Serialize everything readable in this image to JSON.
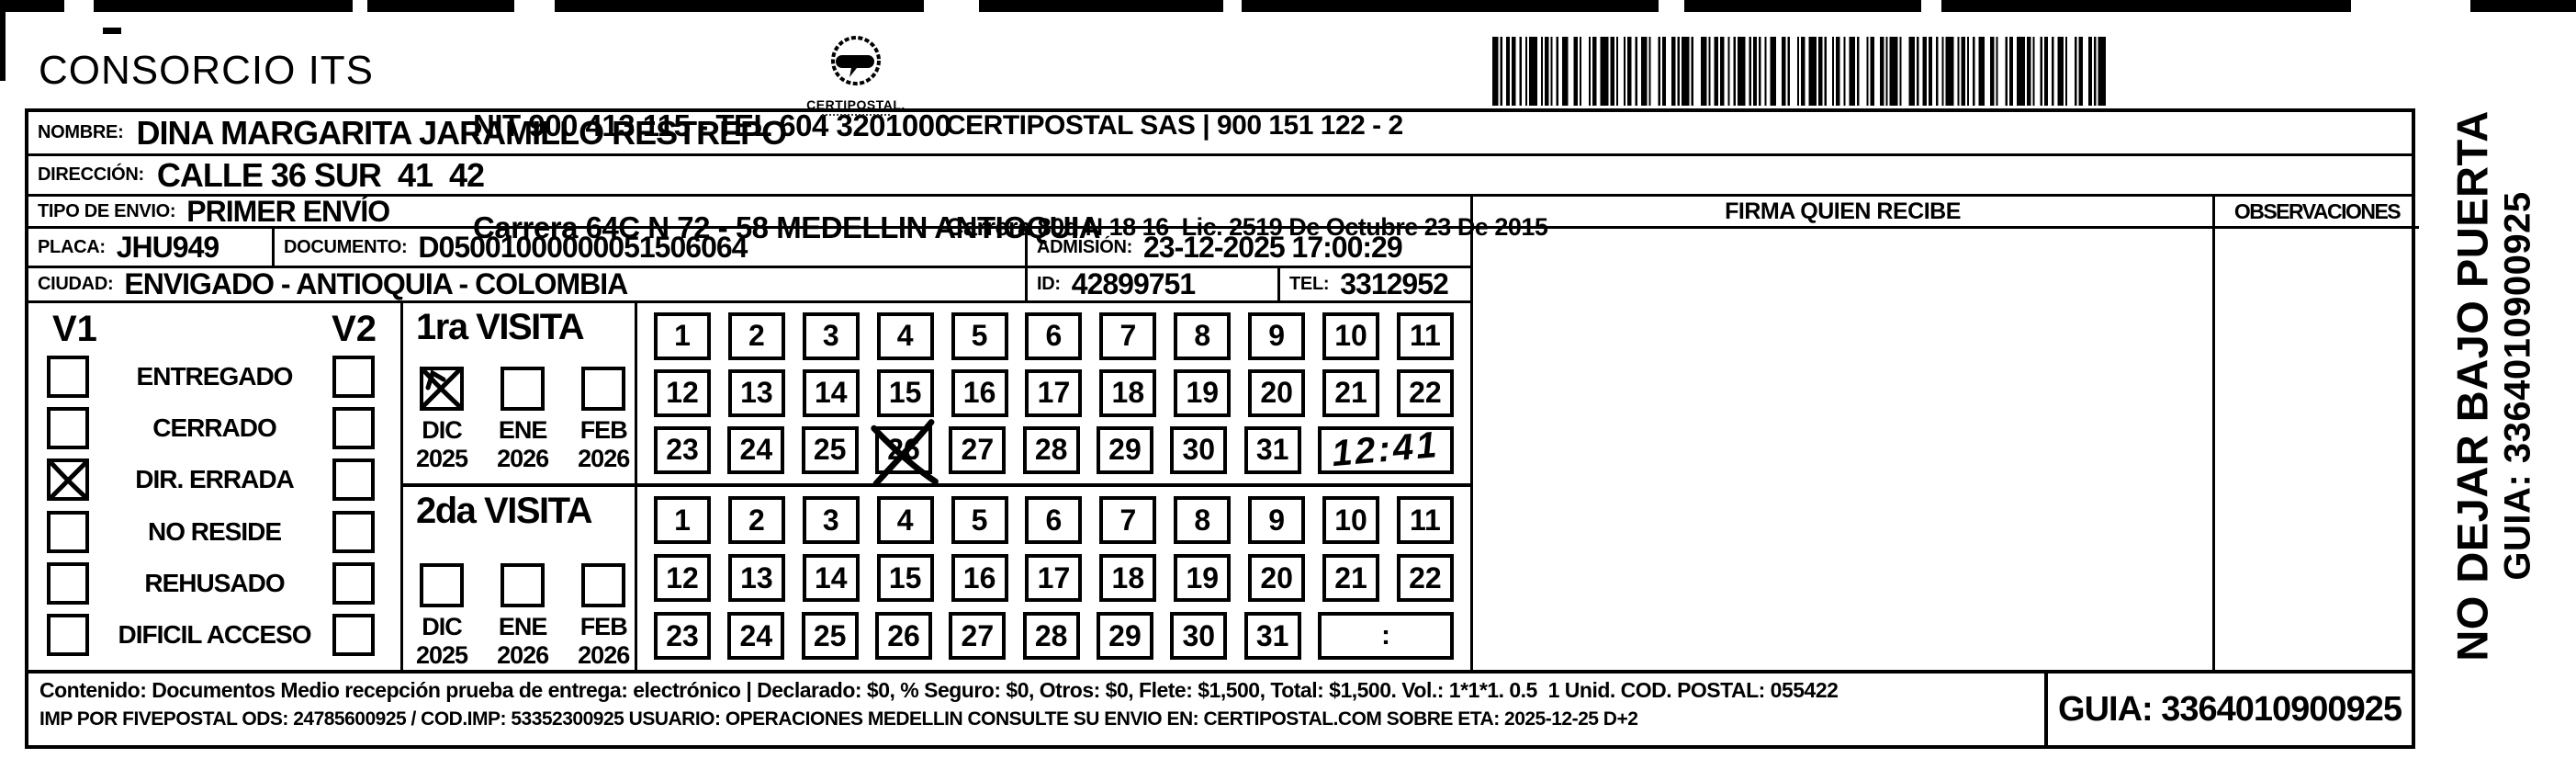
{
  "header": {
    "company": "CONSORCIO ITS",
    "nit_line1": "NIT 900 413 115 - TEL 604 3201000",
    "nit_line2": "Carrera 64C N 72 - 58 MEDELLIN ANTIOQUIA",
    "logo_caption": "CERTIPOSTAL.",
    "carrier_line1": "CERTIPOSTAL SAS | 900 151 122 - 2",
    "carrier_line2": "Carrera 80d N 18 16  Lic. 2519 De Octubre 23 De 2015"
  },
  "shipment": {
    "nombre_label": "NOMBRE:",
    "nombre": "DINA MARGARITA JARAMILLO RESTREPO",
    "direccion_label": "DIRECCIÓN:",
    "direccion": "CALLE 36 SUR  41  42",
    "tipo_label": "TIPO DE ENVIO:",
    "tipo": "PRIMER ENVÍO",
    "placa_label": "PLACA:",
    "placa": "JHU949",
    "documento_label": "DOCUMENTO:",
    "documento": "D05001000000051506064",
    "admision_label": "ADMISIÓN:",
    "admision": "23-12-2025 17:00:29",
    "ciudad_label": "CIUDAD:",
    "ciudad": "ENVIGADO - ANTIOQUIA - COLOMBIA",
    "id_label": "ID:",
    "id_value": "42899751",
    "tel_label": "TEL:",
    "tel": "3312952"
  },
  "status": {
    "v1": "V1",
    "v2": "V2",
    "options": [
      {
        "label": "ENTREGADO",
        "v1": false,
        "v2": false
      },
      {
        "label": "CERRADO",
        "v1": false,
        "v2": false
      },
      {
        "label": "DIR. ERRADA",
        "v1": true,
        "v2": false
      },
      {
        "label": "NO RESIDE",
        "v1": false,
        "v2": false
      },
      {
        "label": "REHUSADO",
        "v1": false,
        "v2": false
      },
      {
        "label": "DIFICIL ACCESO",
        "v1": false,
        "v2": false
      }
    ]
  },
  "visits": [
    {
      "title": "1ra VISITA",
      "months": [
        {
          "month": "DIC",
          "year": "2025",
          "checked": true
        },
        {
          "month": "ENE",
          "year": "2026",
          "checked": false
        },
        {
          "month": "FEB",
          "year": "2026",
          "checked": false
        }
      ],
      "day_rows": [
        [
          1,
          2,
          3,
          4,
          5,
          6,
          7,
          8,
          9,
          10,
          11
        ],
        [
          12,
          13,
          14,
          15,
          16,
          17,
          18,
          19,
          20,
          21,
          22
        ],
        [
          23,
          24,
          25,
          26,
          27,
          28,
          29,
          30,
          31
        ]
      ],
      "crossed_day": 26,
      "time": "12:41",
      "time_handwritten": true
    },
    {
      "title": "2da VISITA",
      "months": [
        {
          "month": "DIC",
          "year": "2025",
          "checked": false
        },
        {
          "month": "ENE",
          "year": "2026",
          "checked": false
        },
        {
          "month": "FEB",
          "year": "2026",
          "checked": false
        }
      ],
      "day_rows": [
        [
          1,
          2,
          3,
          4,
          5,
          6,
          7,
          8,
          9,
          10,
          11
        ],
        [
          12,
          13,
          14,
          15,
          16,
          17,
          18,
          19,
          20,
          21,
          22
        ],
        [
          23,
          24,
          25,
          26,
          27,
          28,
          29,
          30,
          31
        ]
      ],
      "crossed_day": null,
      "time": ":",
      "time_handwritten": false
    }
  ],
  "firma_label": "FIRMA QUIEN RECIBE",
  "observaciones_label": "OBSERVACIONES",
  "side_text": {
    "line1": "NO DEJAR BAJO PUERTA",
    "line2": "GUIA: 3364010900925"
  },
  "footer": {
    "line1": "Contenido: Documentos Medio recepción prueba de entrega: electrónico | Declarado: $0, % Seguro: $0, Otros: $0, Flete: $1,500, Total: $1,500. Vol.: 1*1*1. 0.5  1 Unid. COD. POSTAL: 055422",
    "line2": "IMP POR FIVEPOSTAL ODS: 24785600925 / COD.IMP: 53352300925 USUARIO: OPERACIONES MEDELLIN CONSULTE SU ENVIO EN: CERTIPOSTAL.COM SOBRE ETA: 2025-12-25 D+2",
    "guia": "GUIA: 3364010900925"
  }
}
